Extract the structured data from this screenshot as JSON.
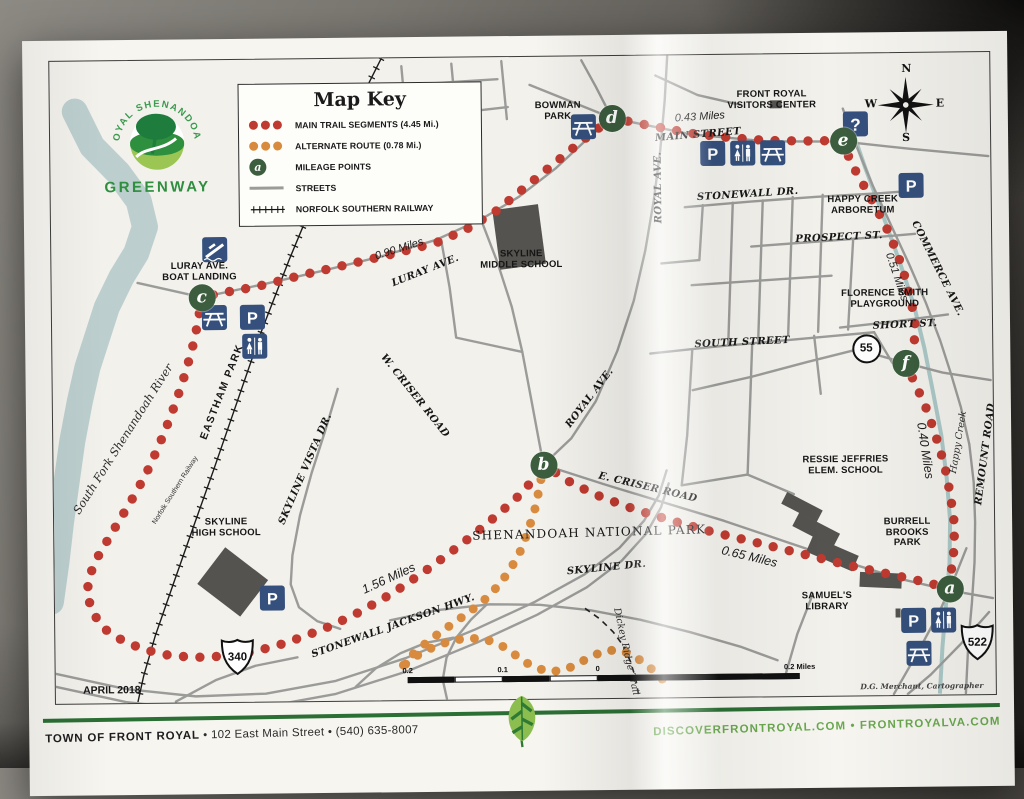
{
  "logo": {
    "arc_text": "ROYAL SHENANDOAH",
    "name": "GREENWAY"
  },
  "map_key": {
    "title": "Map Key",
    "items": [
      {
        "symbol": "red-dots",
        "label": "MAIN TRAIL SEGMENTS (4.45 Mi.)"
      },
      {
        "symbol": "orange-dots",
        "label": "ALTERNATE ROUTE (0.78 Mi.)"
      },
      {
        "symbol": "mileage-point",
        "symbol_letter": "a",
        "label": "MILEAGE POINTS"
      },
      {
        "symbol": "street-line",
        "label": "STREETS"
      },
      {
        "symbol": "railway-line",
        "label": "NORFOLK SOUTHERN RAILWAY"
      }
    ]
  },
  "compass": {
    "n": "N",
    "e": "E",
    "s": "S",
    "w": "W"
  },
  "colors": {
    "main_trail": "#bf3a30",
    "alternate_route": "#d88b3e",
    "mileage_point": "#3c5d3e",
    "icon_blue": "#35507d",
    "street": "#9b9b99",
    "river": "#bccfce",
    "creek": "#aac8c6",
    "building": "#54534f",
    "footer_rule_green": "#2c6f35",
    "footer_url_green": "#6aa84f"
  },
  "mileage_points": [
    {
      "letter": "a",
      "x": 895,
      "y": 536
    },
    {
      "letter": "b",
      "x": 490,
      "y": 408
    },
    {
      "letter": "c",
      "x": 150,
      "y": 237
    },
    {
      "letter": "d",
      "x": 562,
      "y": 62
    },
    {
      "letter": "e",
      "x": 793,
      "y": 87
    },
    {
      "letter": "f",
      "x": 853,
      "y": 310
    }
  ],
  "labels": [
    {
      "t": "BOWMAN\nPARK",
      "x": 508,
      "y": 55,
      "r": 0,
      "c": "place"
    },
    {
      "t": "FRONT ROYAL\nVISITORS CENTER",
      "x": 722,
      "y": 46,
      "r": 0,
      "c": "place"
    },
    {
      "t": "0.43 Miles",
      "x": 650,
      "y": 62,
      "r": -3,
      "c": "miles"
    },
    {
      "t": "MAIN STREET",
      "x": 648,
      "y": 80,
      "r": -4,
      "c": "street"
    },
    {
      "t": "ROYAL AVE.",
      "x": 608,
      "y": 132,
      "r": -90,
      "c": "street"
    },
    {
      "t": "ROYAL AVE.",
      "x": 537,
      "y": 342,
      "r": -52,
      "c": "street"
    },
    {
      "t": "STONEWALL DR.",
      "x": 697,
      "y": 140,
      "r": -3,
      "c": "street"
    },
    {
      "t": "HAPPY CREEK\nARBORETUM",
      "x": 812,
      "y": 152,
      "r": 0,
      "c": "place"
    },
    {
      "t": "PROSPECT ST.",
      "x": 788,
      "y": 184,
      "r": -2,
      "c": "street"
    },
    {
      "t": "COMMERCE AVE.",
      "x": 886,
      "y": 216,
      "r": 64,
      "c": "street"
    },
    {
      "t": "0.51 Miles",
      "x": 845,
      "y": 224,
      "r": 72,
      "c": "miles"
    },
    {
      "t": "FLORENCE SMITH\nPLAYGROUND",
      "x": 833,
      "y": 246,
      "r": 0,
      "c": "place"
    },
    {
      "t": "SHORT ST.",
      "x": 853,
      "y": 272,
      "r": -2,
      "c": "street"
    },
    {
      "t": "SOUTH STREET",
      "x": 690,
      "y": 288,
      "r": -2,
      "c": "street"
    },
    {
      "t": "SKYLINE\nMIDDLE SCHOOL",
      "x": 470,
      "y": 203,
      "r": 0,
      "c": "place"
    },
    {
      "t": "0.90 Miles",
      "x": 348,
      "y": 191,
      "r": -17,
      "c": "miles"
    },
    {
      "t": "LURAY AVE.",
      "x": 374,
      "y": 213,
      "r": -21,
      "c": "street"
    },
    {
      "t": "LURAY AVE.\nBOAT LANDING",
      "x": 148,
      "y": 212,
      "r": 0,
      "c": "place"
    },
    {
      "t": "EASTHAM PARK",
      "x": 170,
      "y": 332,
      "r": -68,
      "c": "place-lg"
    },
    {
      "t": "W. CRISER ROAD",
      "x": 362,
      "y": 338,
      "r": 52,
      "c": "street"
    },
    {
      "t": "SKYLINE VISTA DR.",
      "x": 252,
      "y": 410,
      "r": -66,
      "c": "street"
    },
    {
      "t": "SKYLINE\nHIGH SCHOOL",
      "x": 172,
      "y": 468,
      "r": 0,
      "c": "place"
    },
    {
      "t": "South Fork Shenandoah River",
      "x": 70,
      "y": 378,
      "r": -57,
      "c": "water-lg"
    },
    {
      "t": "Norfolk Southern Railway",
      "x": 122,
      "y": 430,
      "r": -57,
      "c": "tiny"
    },
    {
      "t": "SHENANDOAH NATIONAL PARK",
      "x": 535,
      "y": 477,
      "r": -1,
      "c": "park"
    },
    {
      "t": "SKYLINE DR.",
      "x": 552,
      "y": 512,
      "r": -5,
      "c": "street"
    },
    {
      "t": "E. CRISER ROAD",
      "x": 594,
      "y": 432,
      "r": 14,
      "c": "street"
    },
    {
      "t": "0.65 Miles",
      "x": 695,
      "y": 502,
      "r": 14,
      "c": "miles-lg"
    },
    {
      "t": "RESSIE JEFFRIES\nELEM. SCHOOL",
      "x": 792,
      "y": 412,
      "r": 0,
      "c": "place"
    },
    {
      "t": "0.40 Miles",
      "x": 872,
      "y": 398,
      "r": 82,
      "c": "miles-lg"
    },
    {
      "t": "Happy Creek",
      "x": 906,
      "y": 390,
      "r": -80,
      "c": "water"
    },
    {
      "t": "REMOUNT ROAD",
      "x": 932,
      "y": 402,
      "r": -82,
      "c": "street"
    },
    {
      "t": "BURRELL BROOKS\nPARK",
      "x": 853,
      "y": 480,
      "r": 0,
      "c": "place"
    },
    {
      "t": "SAMUEL'S\nLIBRARY",
      "x": 772,
      "y": 548,
      "r": 0,
      "c": "place"
    },
    {
      "t": "1.56 Miles",
      "x": 334,
      "y": 520,
      "r": -24,
      "c": "miles-lg"
    },
    {
      "t": "STONEWALL JACKSON HWY.",
      "x": 338,
      "y": 568,
      "r": -19,
      "c": "street"
    },
    {
      "t": "Dickey Ridge Trail",
      "x": 570,
      "y": 596,
      "r": 78,
      "c": "water"
    },
    {
      "t": "APRIL 2018",
      "x": 56,
      "y": 630,
      "r": 0,
      "c": "date"
    },
    {
      "t": "D.G. Merchant, Cartographer",
      "x": 866,
      "y": 634,
      "r": 0,
      "c": "credit"
    }
  ],
  "icons": [
    {
      "type": "picnic",
      "x": 533,
      "y": 70
    },
    {
      "type": "info",
      "x": 805,
      "y": 70
    },
    {
      "type": "parking",
      "x": 662,
      "y": 98
    },
    {
      "type": "restroom",
      "x": 692,
      "y": 98
    },
    {
      "type": "picnic",
      "x": 722,
      "y": 98
    },
    {
      "type": "parking",
      "x": 860,
      "y": 132
    },
    {
      "type": "boat",
      "x": 163,
      "y": 189
    },
    {
      "type": "picnic",
      "x": 162,
      "y": 257
    },
    {
      "type": "parking",
      "x": 200,
      "y": 257
    },
    {
      "type": "restroom",
      "x": 202,
      "y": 286
    },
    {
      "type": "parking",
      "x": 217,
      "y": 538
    },
    {
      "type": "parking",
      "x": 858,
      "y": 567
    },
    {
      "type": "restroom",
      "x": 888,
      "y": 567
    },
    {
      "type": "picnic",
      "x": 863,
      "y": 600
    }
  ],
  "route_shields": [
    {
      "kind": "us",
      "text": "340",
      "x": 182,
      "y": 597
    },
    {
      "kind": "us",
      "text": "522",
      "x": 922,
      "y": 590
    },
    {
      "kind": "circle",
      "text": "55",
      "x": 812,
      "y": 293
    }
  ],
  "scale_bar": {
    "labels": [
      {
        "text": "0.2",
        "x": 0
      },
      {
        "text": "0.1",
        "x": 95
      },
      {
        "text": "0",
        "x": 190
      },
      {
        "text": "0.2 Miles",
        "x": 392
      }
    ]
  },
  "footer": {
    "left_name": "TOWN OF FRONT ROYAL",
    "left_rest": " • 102 East Main Street • (540) 635-8007",
    "right": "DISCOVERFRONTROYAL.COM • FRONTROYALVA.COM"
  }
}
